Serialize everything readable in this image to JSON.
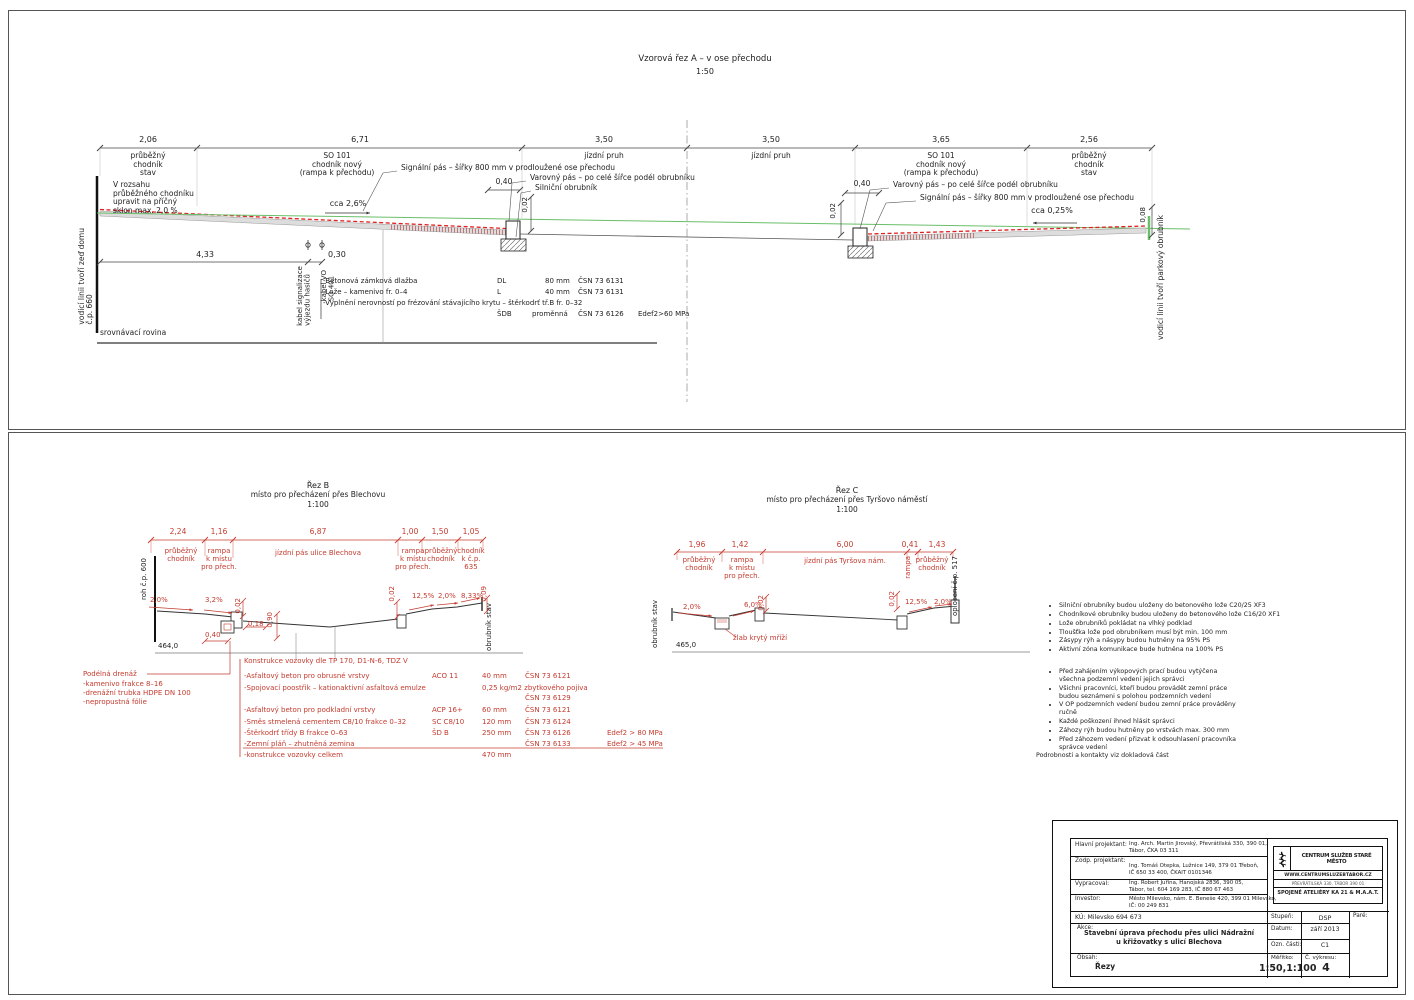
{
  "colors": {
    "annotation_red": "#c43b2f",
    "surface_red": "#e02020",
    "grade_green": "#6abf69"
  },
  "a": {
    "title": "Vzorová řez A – v ose přechodu",
    "scale": "1:50",
    "dims": [
      "2,06",
      "6,71",
      "3,50",
      "3,50",
      "3,65",
      "2,56"
    ],
    "dim_labels": [
      "průběžný\nchodník\nstav",
      "SO 101\nchodník nový\n(rampa k přechodu)",
      "jízdní pruh",
      "jízdní pruh",
      "SO 101\nchodník nový\n(rampa k přechodu)",
      "průběžný\nchodník\nstav"
    ],
    "note_range": "V rozsahu\nprůběžného chodníku\nupravit na příčný\nsklon max. 2,0 %",
    "wall_left": "vodicí linii tvoří zeď domu\nč.p. 660",
    "wall_right": "vodicí linii tvoří parkový obrubník",
    "ann_signal": "Signální pás – šířky 800 mm v prodloužené ose přechodu",
    "ann_warning": "Varovný pás – po celé šířce podél obrubníku",
    "ann_curb": "Silniční obrubník",
    "slope_left": "cca 2,6%",
    "slope_right": "cca 0,25%",
    "d040": "0,40",
    "d002": "0,02",
    "d008": "0,08",
    "d433": "4,33",
    "d030": "0,30",
    "cable1": "kabel signalizace\nvýjezdu hasičů",
    "cable2": "kabel VO\nSO 401",
    "datum": "srovnávací rovina",
    "mat": [
      {
        "n": "-Betonová zámková dlažba",
        "k": "DL",
        "t": "80 mm",
        "m": "ČSN 73 6131",
        "e": ""
      },
      {
        "n": "-Lože – kamenivo fr. 0–4",
        "k": "L",
        "t": "40 mm",
        "m": "ČSN 73 6131",
        "e": ""
      },
      {
        "n": "-Vyplnění nerovností po frézování stávajícího krytu – štěrkodrť tř.B fr. 0–32",
        "k": "",
        "t": "",
        "m": "",
        "e": ""
      },
      {
        "n": "",
        "k": "ŠDB",
        "t": "proměnná",
        "m": "ČSN 73 6126",
        "e": "Edef2>60 MPa"
      }
    ]
  },
  "b": {
    "title": "Řez B",
    "subtitle": "místo pro přecházení přes Blechovu",
    "scale": "1:100",
    "dims": [
      "2,24",
      "1,16",
      "6,87",
      "1,00",
      "1,50",
      "1,05"
    ],
    "dim_labels": [
      "průběžný\nchodník",
      "rampa\nk místu\npro přech.",
      "jízdní pás ulice Blechova",
      "rampa\nk místu\npro přech.",
      "průběžný\nchodník",
      "chodník\nk č.p.\n635"
    ],
    "corner": "roh č.p. 600",
    "s1": "2,0%",
    "s2": "3,2%",
    "d002a": "0,02",
    "d018": "0,18",
    "d090": "0,90",
    "d040": "0,40",
    "elev": "464,0",
    "d002b": "0,02",
    "s3": "12,5%",
    "s4": "2,0%",
    "s5": "8,33%",
    "d009": "0,09",
    "curb_state": "obrubník stav"
  },
  "c": {
    "title": "Řez C",
    "subtitle": "místo pro přecházení přes Tyršovo náměstí",
    "scale": "1:100",
    "dims": [
      "1,96",
      "1,42",
      "6,00",
      "0,41",
      "1,43"
    ],
    "dim_labels": [
      "průběžný\nchodník",
      "rampa\nk místu\npro přech.",
      "jízdní pás Tyršova nám.",
      "rampa",
      "průběžný\nchodník"
    ],
    "curb_state": "obrubník stav",
    "fence": "oplocení č.p. 517",
    "s1": "2,0%",
    "s2": "6,0%",
    "d002a": "0,02",
    "gutter": "žlab krytý mříží",
    "elev": "465,0",
    "d002b": "0,02",
    "s3": "12,5%",
    "s4": "2,0%"
  },
  "drain": {
    "title": "Podélná drenáž",
    "items": [
      "-kamenivo frakce 8–16",
      "-drenážní trubka HDPE DN 100",
      "-nepropustná fólie"
    ]
  },
  "pav": {
    "title": "Konstrukce vozovky dle TP 170, D1-N-6, TDZ V",
    "rows": [
      {
        "n": "-Asfaltový beton pro obrusné vrstvy",
        "k": "ACO 11",
        "t": "40 mm",
        "m": "ČSN 73 6121",
        "e": ""
      },
      {
        "n": "-Spojovací poostřik – kationaktivní asfaltová emulze",
        "k": "",
        "t": "0,25 kg/m2 zbytkového pojiva",
        "m": "",
        "e": ""
      },
      {
        "n": "",
        "k": "",
        "t": "",
        "m": "ČSN 73 6129",
        "e": ""
      },
      {
        "n": "-Asfaltový beton pro podkladní vrstvy",
        "k": "ACP 16+",
        "t": "60 mm",
        "m": "ČSN 73 6121",
        "e": ""
      },
      {
        "n": "-Směs stmelená cementem C8/10 frakce 0–32",
        "k": "SC C8/10",
        "t": "120 mm",
        "m": "ČSN 73 6124",
        "e": ""
      },
      {
        "n": "-Štěrkodrť třídy B frakce 0–63",
        "k": "ŠD B",
        "t": "250 mm",
        "m": "ČSN 73 6126",
        "e": "Edef2 > 80 MPa"
      },
      {
        "n": "-Zemní pláň – zhutněná zemina",
        "k": "",
        "t": "",
        "m": "ČSN 73 6133",
        "e": "Edef2 > 45 MPa"
      },
      {
        "n": "-konstrukce vozovky celkem",
        "k": "",
        "t": "470 mm",
        "m": "",
        "e": ""
      }
    ]
  },
  "notes1": [
    "Silniční obrubníky budou uloženy do betonového lože C20/25 XF3",
    "Chodníkové obrubníky budou uloženy do betonového lože C16/20 XF1",
    "Lože obrubníků pokládat na vlhký podklad",
    "Tloušťka lože pod obrubníkem musí být min. 100 mm",
    "Zásypy rýh a násypy budou hutněny na 95% PS",
    "Aktivní zóna komunikace bude hutněna na 100% PS"
  ],
  "notes2": [
    "Před zahájením výkopových prací budou vytýčena\nvšechna podzemní vedení jejich správci",
    "Všichni pracovníci, kteří budou provádět zemní práce\nbudou seznámeni s polohou podzemních vedení",
    "V OP podzemních vedení budou zemní práce prováděny\nručně",
    "Každé poškození ihned hlásit správci",
    "Záhozy rýh budou hutněny po vrstvách max. 300 mm",
    "Před záhozem vedení přizvat k odsouhlasení pracovníka\nsprávce vedení"
  ],
  "notes_footer": "Podrobnosti a kontakty viz dokladová část",
  "tb": {
    "rows": [
      {
        "l": "Hlavní projektant:",
        "v": "Ing. Arch. Martin Jirovský, Převrátilská 330, 390 01,\nTábor, ČKA 03 311"
      },
      {
        "l": "Zodp. projektant:",
        "v": "Ing. Tomáš Otepka, Lužnice 149, 379 01 Třeboň,\nIČ 650 33 400, ČKAIT 0101346"
      },
      {
        "l": "Vypracoval:",
        "v": "Ing. Robert Juřina, Hanojská 2836, 390 05,\nTábor, tel. 604 169 283, IČ 880 67 463"
      },
      {
        "l": "Investor:",
        "v": "Město Milevsko, nám. E. Beneše 420, 399 01 Milevsko,\nIČ: 00 249 831"
      }
    ],
    "ku": "KÚ: Milevsko 694 673",
    "akce_l": "Akce:",
    "akce": "Stavební úprava přechodu přes ulici Nádražní\nu křižovatky s ulicí Blechova",
    "obsah_l": "Obsah:",
    "obsah": "Řezy",
    "stupen_l": "Stupeň:",
    "stupen": "DSP",
    "pare_l": "Paré:",
    "datum_l": "Datum:",
    "datum": "září 2013",
    "ozn_l": "Ozn. části:",
    "ozn": "C1",
    "mer_l": "Měřítko:",
    "mer": "1:50,1:100",
    "cis_l": "Č. výkresu:",
    "cis": "4",
    "logo": {
      "name": "CENTRUM SLUŽEB STARÉ MĚSTO",
      "web": "WWW.CENTRUMSLUZEBTABOR.CZ",
      "addr": "PŘEVRÁTILSKÁ 330, TÁBOR 390 01",
      "atelier": "SPOJENÉ ATELIÉRY KA 21 & M.A.A.T."
    }
  }
}
